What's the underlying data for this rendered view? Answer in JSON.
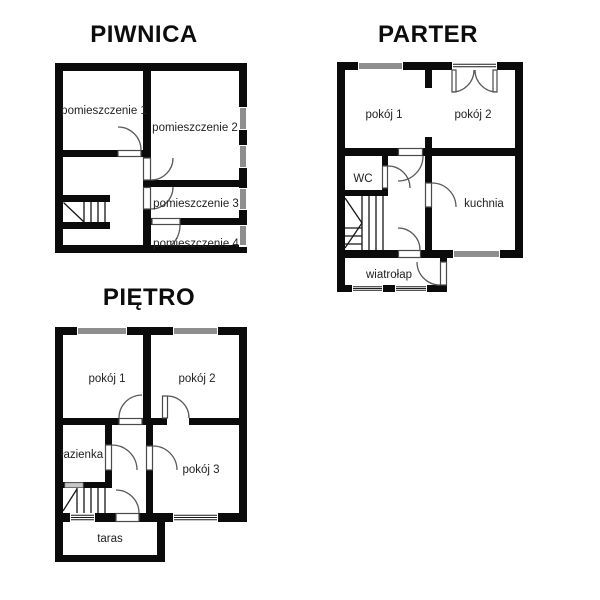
{
  "colors": {
    "background": "#ffffff",
    "wall": "#0b0b0b",
    "door_line": "#5a5a5a",
    "text": "#222222",
    "gray_door": "#c6c6c6"
  },
  "floors": [
    {
      "id": "piwnica",
      "title": "PIWNICA",
      "rooms": [
        "pomieszczenie 1",
        "pomieszczenie 2",
        "pomieszczenie 3",
        "pomieszczenie 4"
      ]
    },
    {
      "id": "parter",
      "title": "PARTER",
      "rooms": [
        "pokój 1",
        "pokój 2",
        "WC",
        "kuchnia",
        "wiatrołap"
      ]
    },
    {
      "id": "pietro",
      "title": "PIĘTRO",
      "rooms": [
        "pokój 1",
        "pokój 2",
        "łazienka",
        "pokój 3",
        "taras"
      ]
    }
  ]
}
